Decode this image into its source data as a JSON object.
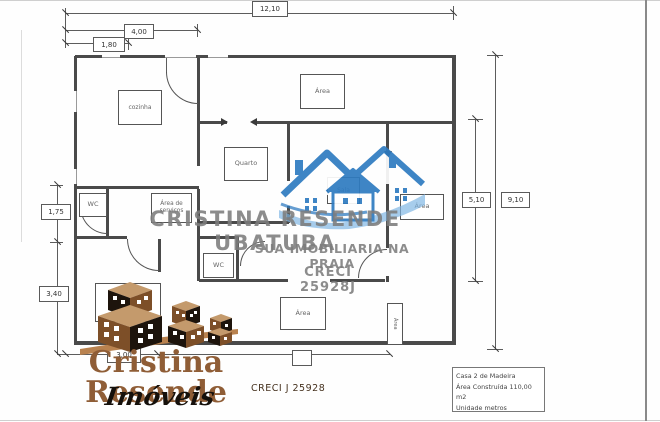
{
  "plan": {
    "rooms": {
      "cozinha": "cozinha",
      "area_top": "Área",
      "quarto": "Quarto",
      "sala": "Sala",
      "wc_upper": "WC",
      "area_servicos": "Área de serviços",
      "wc_lower": "WC",
      "area_right": "Área",
      "area_bottom": "Área",
      "area_vertical": "Área"
    },
    "dimensions": {
      "top_overall": "12,10",
      "top_kitchen": "4,00",
      "top_small": "1,80",
      "left_upper": "1,75",
      "left_lower": "3,40",
      "right_inner": "5,10",
      "right_overall": "9,10",
      "bottom": "3,00"
    }
  },
  "watermark": {
    "line1": "CRISTINA RESENDE UBATUBA",
    "line2": "SUA IMOBILIARIA NA PRAIA",
    "line3": "CRECI 25928J",
    "text_color": "#7d7d7d",
    "house_blue": "#2e7bc1",
    "house_blue_light": "#7fb6e3"
  },
  "brand": {
    "name": "Cristina Resende",
    "subtitle": "Imóveis",
    "creci": "CRECI J 25928",
    "brown": "#8f5d36",
    "dark": "#1d140c",
    "tan": "#c49a6c"
  },
  "info_box": {
    "line1": "Casa 2 de Madeira",
    "line2": "Área Construída 110,00 m2",
    "line3": "Unidade metros"
  }
}
